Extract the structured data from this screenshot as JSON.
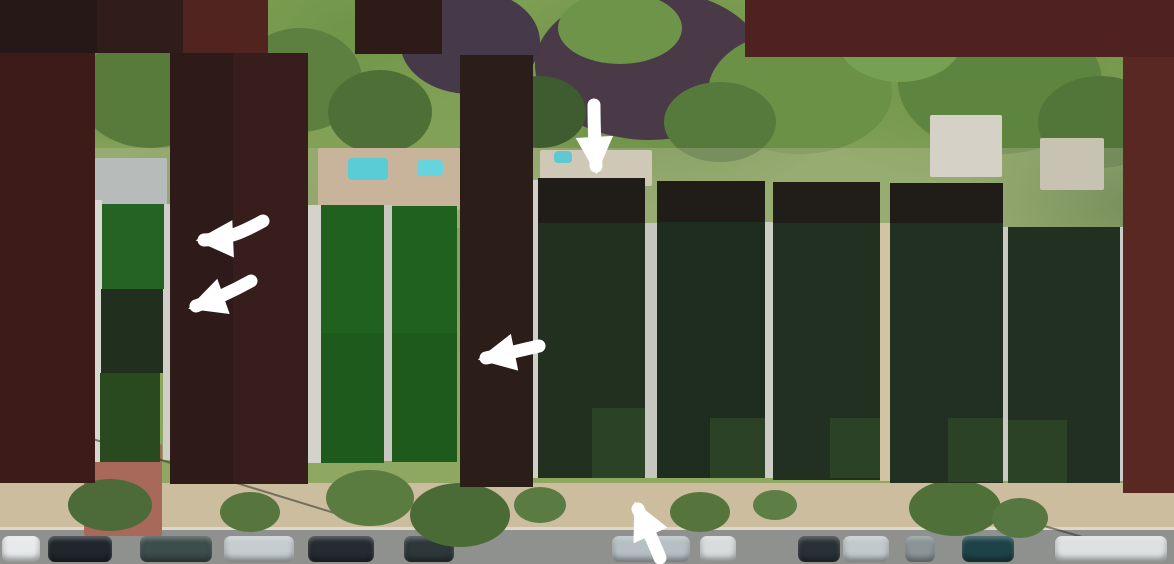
{
  "canvas": {
    "w": 1174,
    "h": 564
  },
  "background": {
    "foliage_base": "#7d9e53",
    "sidewalk": "#cbbd9d",
    "road": "#8f918f",
    "annotation_white": "#ffffff"
  },
  "photo": {
    "canopy_blobs": [
      {
        "cx": 650,
        "cy": 65,
        "rx": 115,
        "ry": 75,
        "c": "#4a3947"
      },
      {
        "cx": 470,
        "cy": 42,
        "rx": 70,
        "ry": 52,
        "c": "#463a4a"
      },
      {
        "cx": 300,
        "cy": 80,
        "rx": 62,
        "ry": 52,
        "c": "#5d8040"
      },
      {
        "cx": 620,
        "cy": 28,
        "rx": 62,
        "ry": 36,
        "c": "#6d9448"
      },
      {
        "cx": 800,
        "cy": 92,
        "rx": 92,
        "ry": 62,
        "c": "#6a9146"
      },
      {
        "cx": 1000,
        "cy": 82,
        "rx": 102,
        "ry": 72,
        "c": "#5e8540"
      },
      {
        "cx": 900,
        "cy": 40,
        "rx": 62,
        "ry": 42,
        "c": "#76a052"
      },
      {
        "cx": 150,
        "cy": 92,
        "rx": 72,
        "ry": 56,
        "c": "#587b3c"
      },
      {
        "cx": 380,
        "cy": 112,
        "rx": 52,
        "ry": 42,
        "c": "#4e7036"
      },
      {
        "cx": 1100,
        "cy": 122,
        "rx": 62,
        "ry": 46,
        "c": "#527539"
      },
      {
        "cx": 540,
        "cy": 112,
        "rx": 46,
        "ry": 36,
        "c": "#3e5c30"
      },
      {
        "cx": 720,
        "cy": 122,
        "rx": 56,
        "ry": 40,
        "c": "#557a3c"
      },
      {
        "cx": 60,
        "cy": 510,
        "rx": 50,
        "ry": 30,
        "c": "#6b8a48"
      }
    ],
    "bands": [
      {
        "name": "house-row-band",
        "x": 0,
        "y": 148,
        "w": 1174,
        "h": 80,
        "c": "rgba(206,199,178,0.28)"
      },
      {
        "name": "sidewalk",
        "x": 0,
        "y": 483,
        "w": 1174,
        "h": 47,
        "c": "#cbbd9d"
      },
      {
        "name": "curb-line",
        "x": 0,
        "y": 527,
        "w": 1174,
        "h": 3,
        "c": "#dcd8ca"
      },
      {
        "name": "road",
        "x": 0,
        "y": 530,
        "w": 1174,
        "h": 34,
        "c": "#8f918f"
      }
    ],
    "roofs": [
      {
        "name": "gray-gable-roof",
        "x": 95,
        "y": 158,
        "w": 72,
        "h": 48,
        "c": "#b7bbba"
      },
      {
        "name": "patio-deck",
        "x": 318,
        "y": 148,
        "w": 142,
        "h": 62,
        "c": "#c8b49a"
      },
      {
        "name": "flat-roof-center",
        "x": 540,
        "y": 150,
        "w": 112,
        "h": 36,
        "c": "#cfc8b6"
      },
      {
        "name": "right-house-roof",
        "x": 930,
        "y": 115,
        "w": 72,
        "h": 62,
        "c": "#d6d1c6"
      },
      {
        "name": "far-right-roof",
        "x": 1040,
        "y": 138,
        "w": 64,
        "h": 52,
        "c": "#c8c2b2"
      }
    ],
    "pools": [
      {
        "name": "pool-large",
        "x": 348,
        "y": 158,
        "w": 40,
        "h": 22,
        "c": "#59ccd6"
      },
      {
        "name": "pool-small",
        "x": 417,
        "y": 160,
        "w": 26,
        "h": 16,
        "c": "#66d4dd"
      },
      {
        "name": "pool-right",
        "x": 554,
        "y": 151,
        "w": 18,
        "h": 12,
        "c": "#5fc8d2"
      }
    ],
    "brick_buildings": [
      {
        "name": "brick-facade-left",
        "x": 84,
        "y": 444,
        "w": 78,
        "h": 92,
        "c": "#a8685a"
      }
    ],
    "gap_strips": [
      {
        "x": 95,
        "y": 200,
        "w": 7,
        "h": 262,
        "c": "#d8d8d2"
      },
      {
        "x": 163,
        "y": 204,
        "w": 7,
        "h": 256,
        "c": "#cfcfc8"
      },
      {
        "x": 308,
        "y": 205,
        "w": 13,
        "h": 258,
        "c": "#d3d3cc"
      },
      {
        "x": 384,
        "y": 205,
        "w": 8,
        "h": 256,
        "c": "#c8c8c0"
      },
      {
        "x": 533,
        "y": 180,
        "w": 5,
        "h": 298,
        "c": "#d0d0c8"
      },
      {
        "x": 645,
        "y": 223,
        "w": 12,
        "h": 255,
        "c": "#c6c6c0"
      },
      {
        "x": 765,
        "y": 222,
        "w": 8,
        "h": 256,
        "c": "#ccccc4"
      },
      {
        "x": 880,
        "y": 223,
        "w": 10,
        "h": 258,
        "c": "#d2c4a2"
      },
      {
        "x": 1003,
        "y": 227,
        "w": 5,
        "h": 254,
        "c": "#c9c9c2"
      },
      {
        "x": 1120,
        "y": 227,
        "w": 3,
        "h": 254,
        "c": "#cccccc"
      }
    ],
    "shadow_lines": [
      {
        "x": 60,
        "y": 428,
        "len": 300,
        "rot": 17,
        "c": "#1e231e"
      },
      {
        "x": 950,
        "y": 498,
        "len": 220,
        "rot": 16,
        "c": "#1e231e"
      }
    ],
    "car_row": {
      "y": 536,
      "cars": [
        {
          "x": 2,
          "w": 38,
          "c": "#e6eaea"
        },
        {
          "x": 48,
          "w": 64,
          "c": "#20262c"
        },
        {
          "x": 140,
          "w": 72,
          "c": "#3c4e4c"
        },
        {
          "x": 224,
          "w": 70,
          "c": "#c6cdd0"
        },
        {
          "x": 308,
          "w": 66,
          "c": "#252b31"
        },
        {
          "x": 404,
          "w": 50,
          "c": "#2e383a"
        },
        {
          "x": 612,
          "w": 78,
          "c": "#b6bfc3"
        },
        {
          "x": 700,
          "w": 36,
          "c": "#d8dcdd"
        },
        {
          "x": 798,
          "w": 42,
          "c": "#2a3136"
        },
        {
          "x": 843,
          "w": 46,
          "c": "#c2c9cd"
        },
        {
          "x": 905,
          "w": 30,
          "c": "#8b9597"
        },
        {
          "x": 962,
          "w": 52,
          "c": "#1d4349"
        },
        {
          "x": 1055,
          "w": 112,
          "c": "#dde1e2"
        }
      ]
    },
    "street_trees": [
      {
        "cx": 110,
        "cy": 505,
        "rx": 42,
        "ry": 26,
        "c": "#4c6b38"
      },
      {
        "cx": 250,
        "cy": 512,
        "rx": 30,
        "ry": 20,
        "c": "#56763e"
      },
      {
        "cx": 370,
        "cy": 498,
        "rx": 44,
        "ry": 28,
        "c": "#5a7c40"
      },
      {
        "cx": 460,
        "cy": 515,
        "rx": 50,
        "ry": 32,
        "c": "#4a6a36"
      },
      {
        "cx": 540,
        "cy": 505,
        "rx": 26,
        "ry": 18,
        "c": "#5a7c42"
      },
      {
        "cx": 700,
        "cy": 512,
        "rx": 30,
        "ry": 20,
        "c": "#55753d"
      },
      {
        "cx": 775,
        "cy": 505,
        "rx": 22,
        "ry": 15,
        "c": "#5d7e44"
      },
      {
        "cx": 955,
        "cy": 508,
        "rx": 46,
        "ry": 28,
        "c": "#4f7038"
      },
      {
        "cx": 1020,
        "cy": 518,
        "rx": 28,
        "ry": 20,
        "c": "#567741"
      }
    ]
  },
  "overlays": {
    "dark_blocks": [
      {
        "name": "top-left-near-black",
        "x": 0,
        "y": 0,
        "w": 97,
        "h": 53,
        "c": "#261817"
      },
      {
        "name": "top-left-maroon",
        "x": 97,
        "y": 0,
        "w": 86,
        "h": 53,
        "c": "#301c1b"
      },
      {
        "name": "top-left-red-maroon",
        "x": 183,
        "y": 0,
        "w": 85,
        "h": 54,
        "c": "#522420"
      },
      {
        "name": "top-middle-block",
        "x": 355,
        "y": 0,
        "w": 87,
        "h": 54,
        "c": "#2e1b18"
      },
      {
        "name": "top-right-block",
        "x": 745,
        "y": 0,
        "w": 429,
        "h": 57,
        "c": "#4f2120"
      },
      {
        "name": "right-edge-strip",
        "x": 1123,
        "y": 57,
        "w": 51,
        "h": 436,
        "c": "#5a2823"
      },
      {
        "name": "left-tall-block",
        "x": 0,
        "y": 53,
        "w": 95,
        "h": 430,
        "c": "#3d1b19"
      },
      {
        "name": "center-left-column-a",
        "x": 170,
        "y": 53,
        "w": 63,
        "h": 431,
        "c": "#2d1a19"
      },
      {
        "name": "center-left-column-b",
        "x": 233,
        "y": 53,
        "w": 75,
        "h": 431,
        "c": "#371e1d"
      },
      {
        "name": "center-column",
        "x": 460,
        "y": 55,
        "w": 73,
        "h": 432,
        "c": "#2b1d17"
      }
    ],
    "green_blocks": [
      {
        "name": "left-stack-top",
        "x": 102,
        "y": 204,
        "w": 62,
        "h": 85,
        "c": "#256325"
      },
      {
        "name": "left-stack-middle",
        "x": 101,
        "y": 289,
        "w": 62,
        "h": 84,
        "c": "#212f1f"
      },
      {
        "name": "left-stack-bottom",
        "x": 100,
        "y": 373,
        "w": 60,
        "h": 89,
        "c": "#284a1e"
      },
      {
        "name": "mid-green-1-upper",
        "x": 321,
        "y": 205,
        "w": 63,
        "h": 128,
        "c": "#20611d"
      },
      {
        "name": "mid-green-1-lower",
        "x": 321,
        "y": 333,
        "w": 63,
        "h": 130,
        "c": "#1e5a1b"
      },
      {
        "name": "mid-green-2-upper",
        "x": 392,
        "y": 206,
        "w": 65,
        "h": 127,
        "c": "#20611d"
      },
      {
        "name": "mid-green-2-lower",
        "x": 392,
        "y": 333,
        "w": 65,
        "h": 129,
        "c": "#1e5a1b"
      }
    ],
    "caps": [
      {
        "x": 538,
        "y": 178,
        "w": 107,
        "h": 45,
        "c": "#201c18"
      },
      {
        "x": 657,
        "y": 181,
        "w": 108,
        "h": 41,
        "c": "#201c18"
      },
      {
        "x": 773,
        "y": 182,
        "w": 107,
        "h": 41,
        "c": "#211d19"
      },
      {
        "x": 890,
        "y": 183,
        "w": 113,
        "h": 40,
        "c": "#201c18"
      }
    ],
    "dark_green_columns": [
      {
        "x": 538,
        "y": 223,
        "w": 107,
        "h": 255,
        "c": "#223020"
      },
      {
        "x": 657,
        "y": 222,
        "w": 108,
        "h": 256,
        "c": "#1f2d1e"
      },
      {
        "x": 773,
        "y": 223,
        "w": 107,
        "h": 257,
        "c": "#213020"
      },
      {
        "x": 890,
        "y": 223,
        "w": 113,
        "h": 260,
        "c": "#213020"
      },
      {
        "x": 1008,
        "y": 227,
        "w": 112,
        "h": 256,
        "c": "#213020"
      }
    ],
    "light_patches": [
      {
        "x": 592,
        "y": 408,
        "w": 53,
        "h": 70,
        "c": "#2b4227"
      },
      {
        "x": 710,
        "y": 418,
        "w": 55,
        "h": 60,
        "c": "#2b4227"
      },
      {
        "x": 830,
        "y": 418,
        "w": 50,
        "h": 60,
        "c": "#2b4227"
      },
      {
        "x": 948,
        "y": 418,
        "w": 55,
        "h": 64,
        "c": "#2b4227"
      },
      {
        "x": 1008,
        "y": 420,
        "w": 59,
        "h": 63,
        "c": "#2b4227"
      }
    ]
  },
  "arrows": {
    "color": "#ffffff",
    "stroke_width": 13,
    "items": [
      {
        "name": "arrow-left-upper",
        "d": "M263,221 C243,232 228,239 204,240"
      },
      {
        "name": "arrow-left-lower",
        "d": "M251,281 C233,291 216,299 196,306"
      },
      {
        "name": "arrow-middle-left",
        "d": "M539,346 C517,351 501,355 486,358"
      },
      {
        "name": "arrow-top-down",
        "d": "M594,105 C594,128 595,148 596,166"
      },
      {
        "name": "arrow-bottom-up",
        "d": "M660,558 C653,540 646,526 638,509"
      }
    ]
  }
}
